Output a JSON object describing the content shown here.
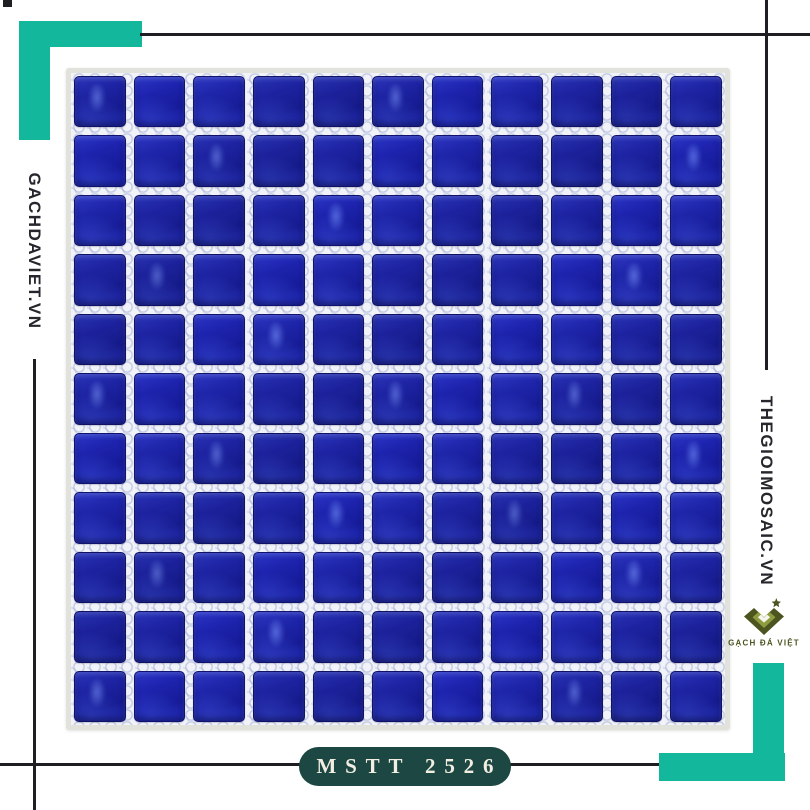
{
  "branding": {
    "left_site": "GACHDAVIET.VN",
    "right_site": "THEGIOIMOSAIC.VN",
    "logo_icon": "diamond-chevron-star",
    "logo_caption": "GẠCH ĐÁ VIỆT"
  },
  "product": {
    "code_label": "MSTT 2526",
    "subject": "blue glass mosaic tile sheet"
  },
  "mosaic": {
    "rows": 11,
    "cols": 11
  },
  "colors": {
    "accent_teal": "#13b89c",
    "line": "#1f1f23",
    "badge_bg": "#1c4742",
    "badge_text": "#f2eee2",
    "tile_base": "#1d23a2",
    "tile_deep": "#161b90",
    "tile_glow": "#2c36bc",
    "logo_olive_dark": "#4c5420",
    "logo_olive_light": "#8d9c3e"
  }
}
